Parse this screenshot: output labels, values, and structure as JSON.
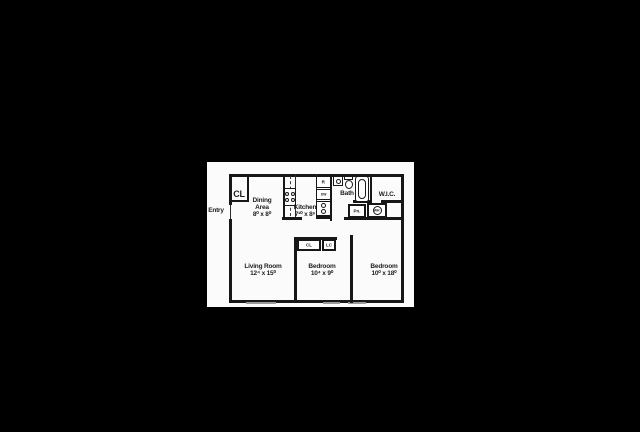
{
  "scene": {
    "background_color": "#000000",
    "paper_color": "#fbfbfb",
    "line_color": "#171717",
    "window_color": "#9a9a9a"
  },
  "floorplan": {
    "entry": {
      "label": "Entry"
    },
    "rooms": {
      "dining": {
        "name": "Dining Area",
        "dims": "8⁰ x 8⁰"
      },
      "kitchen": {
        "name": "Kitchen",
        "dims": "7¹⁰ x 8⁶"
      },
      "bath": {
        "name": "Bath"
      },
      "wic": {
        "name": "W.I.C."
      },
      "living": {
        "name": "Living Room",
        "dims": "12⁴ x 15⁰"
      },
      "bedroom_middle": {
        "name": "Bedroom",
        "dims": "10⁴ x 9⁰"
      },
      "bedroom_right": {
        "name": "Bedroom",
        "dims": "10⁰ x 18⁰"
      }
    },
    "closets": {
      "entry_closet": "CL",
      "hall_closet": "CL",
      "linen_closet": "LC",
      "pantry": "Pn."
    },
    "appliances": {
      "refrigerator": "R",
      "dishwasher": "DW",
      "water_heater": "WH"
    }
  }
}
